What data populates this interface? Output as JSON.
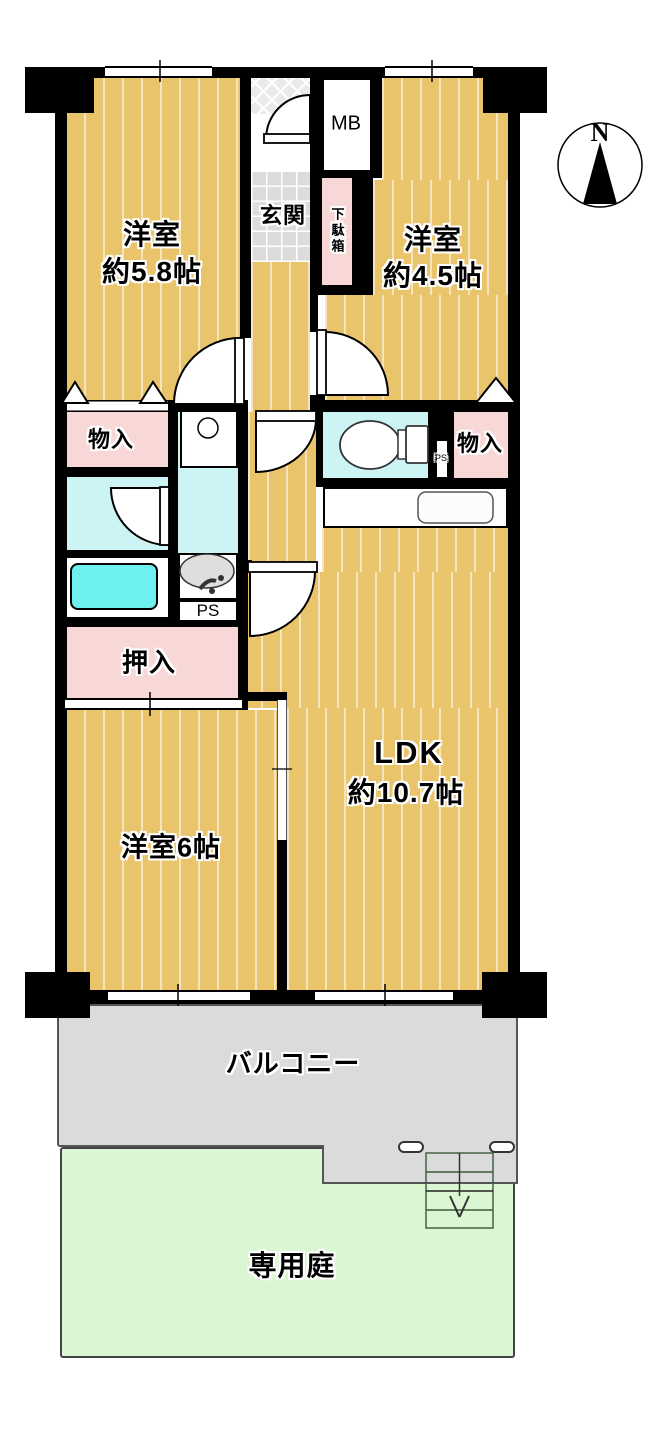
{
  "colors": {
    "wall": "#000000",
    "floor": "#E9C46B",
    "pink": "#F8D7D7",
    "cyan": "#CDF4F4",
    "tub": "#6FF0F0",
    "genkan": "#DCDCDC",
    "porch": "#EAEAEA",
    "balcony": "#DBDBDB",
    "garden": "#DAF6D2"
  },
  "compass": {
    "label": "N"
  },
  "rooms": {
    "bedroom_nw": {
      "name": "洋室",
      "size": "約5.8帖"
    },
    "bedroom_ne": {
      "name": "洋室",
      "size": "約4.5帖"
    },
    "bedroom_sw": {
      "label": "洋室6帖"
    },
    "ldk": {
      "name": "LDK",
      "size": "約10.7帖"
    },
    "entrance": {
      "label": "玄関"
    },
    "shoe_cabinet": {
      "label": "下駄箱"
    },
    "meter_box": {
      "label": "MB"
    },
    "storage_west": {
      "label": "物入"
    },
    "storage_east": {
      "label": "物入"
    },
    "closet": {
      "label": "押入"
    },
    "pipe_space_center": {
      "label": "PS"
    },
    "pipe_space_east": {
      "label": "PS"
    },
    "balcony": {
      "label": "バルコニー"
    },
    "private_garden": {
      "label": "専用庭"
    }
  }
}
